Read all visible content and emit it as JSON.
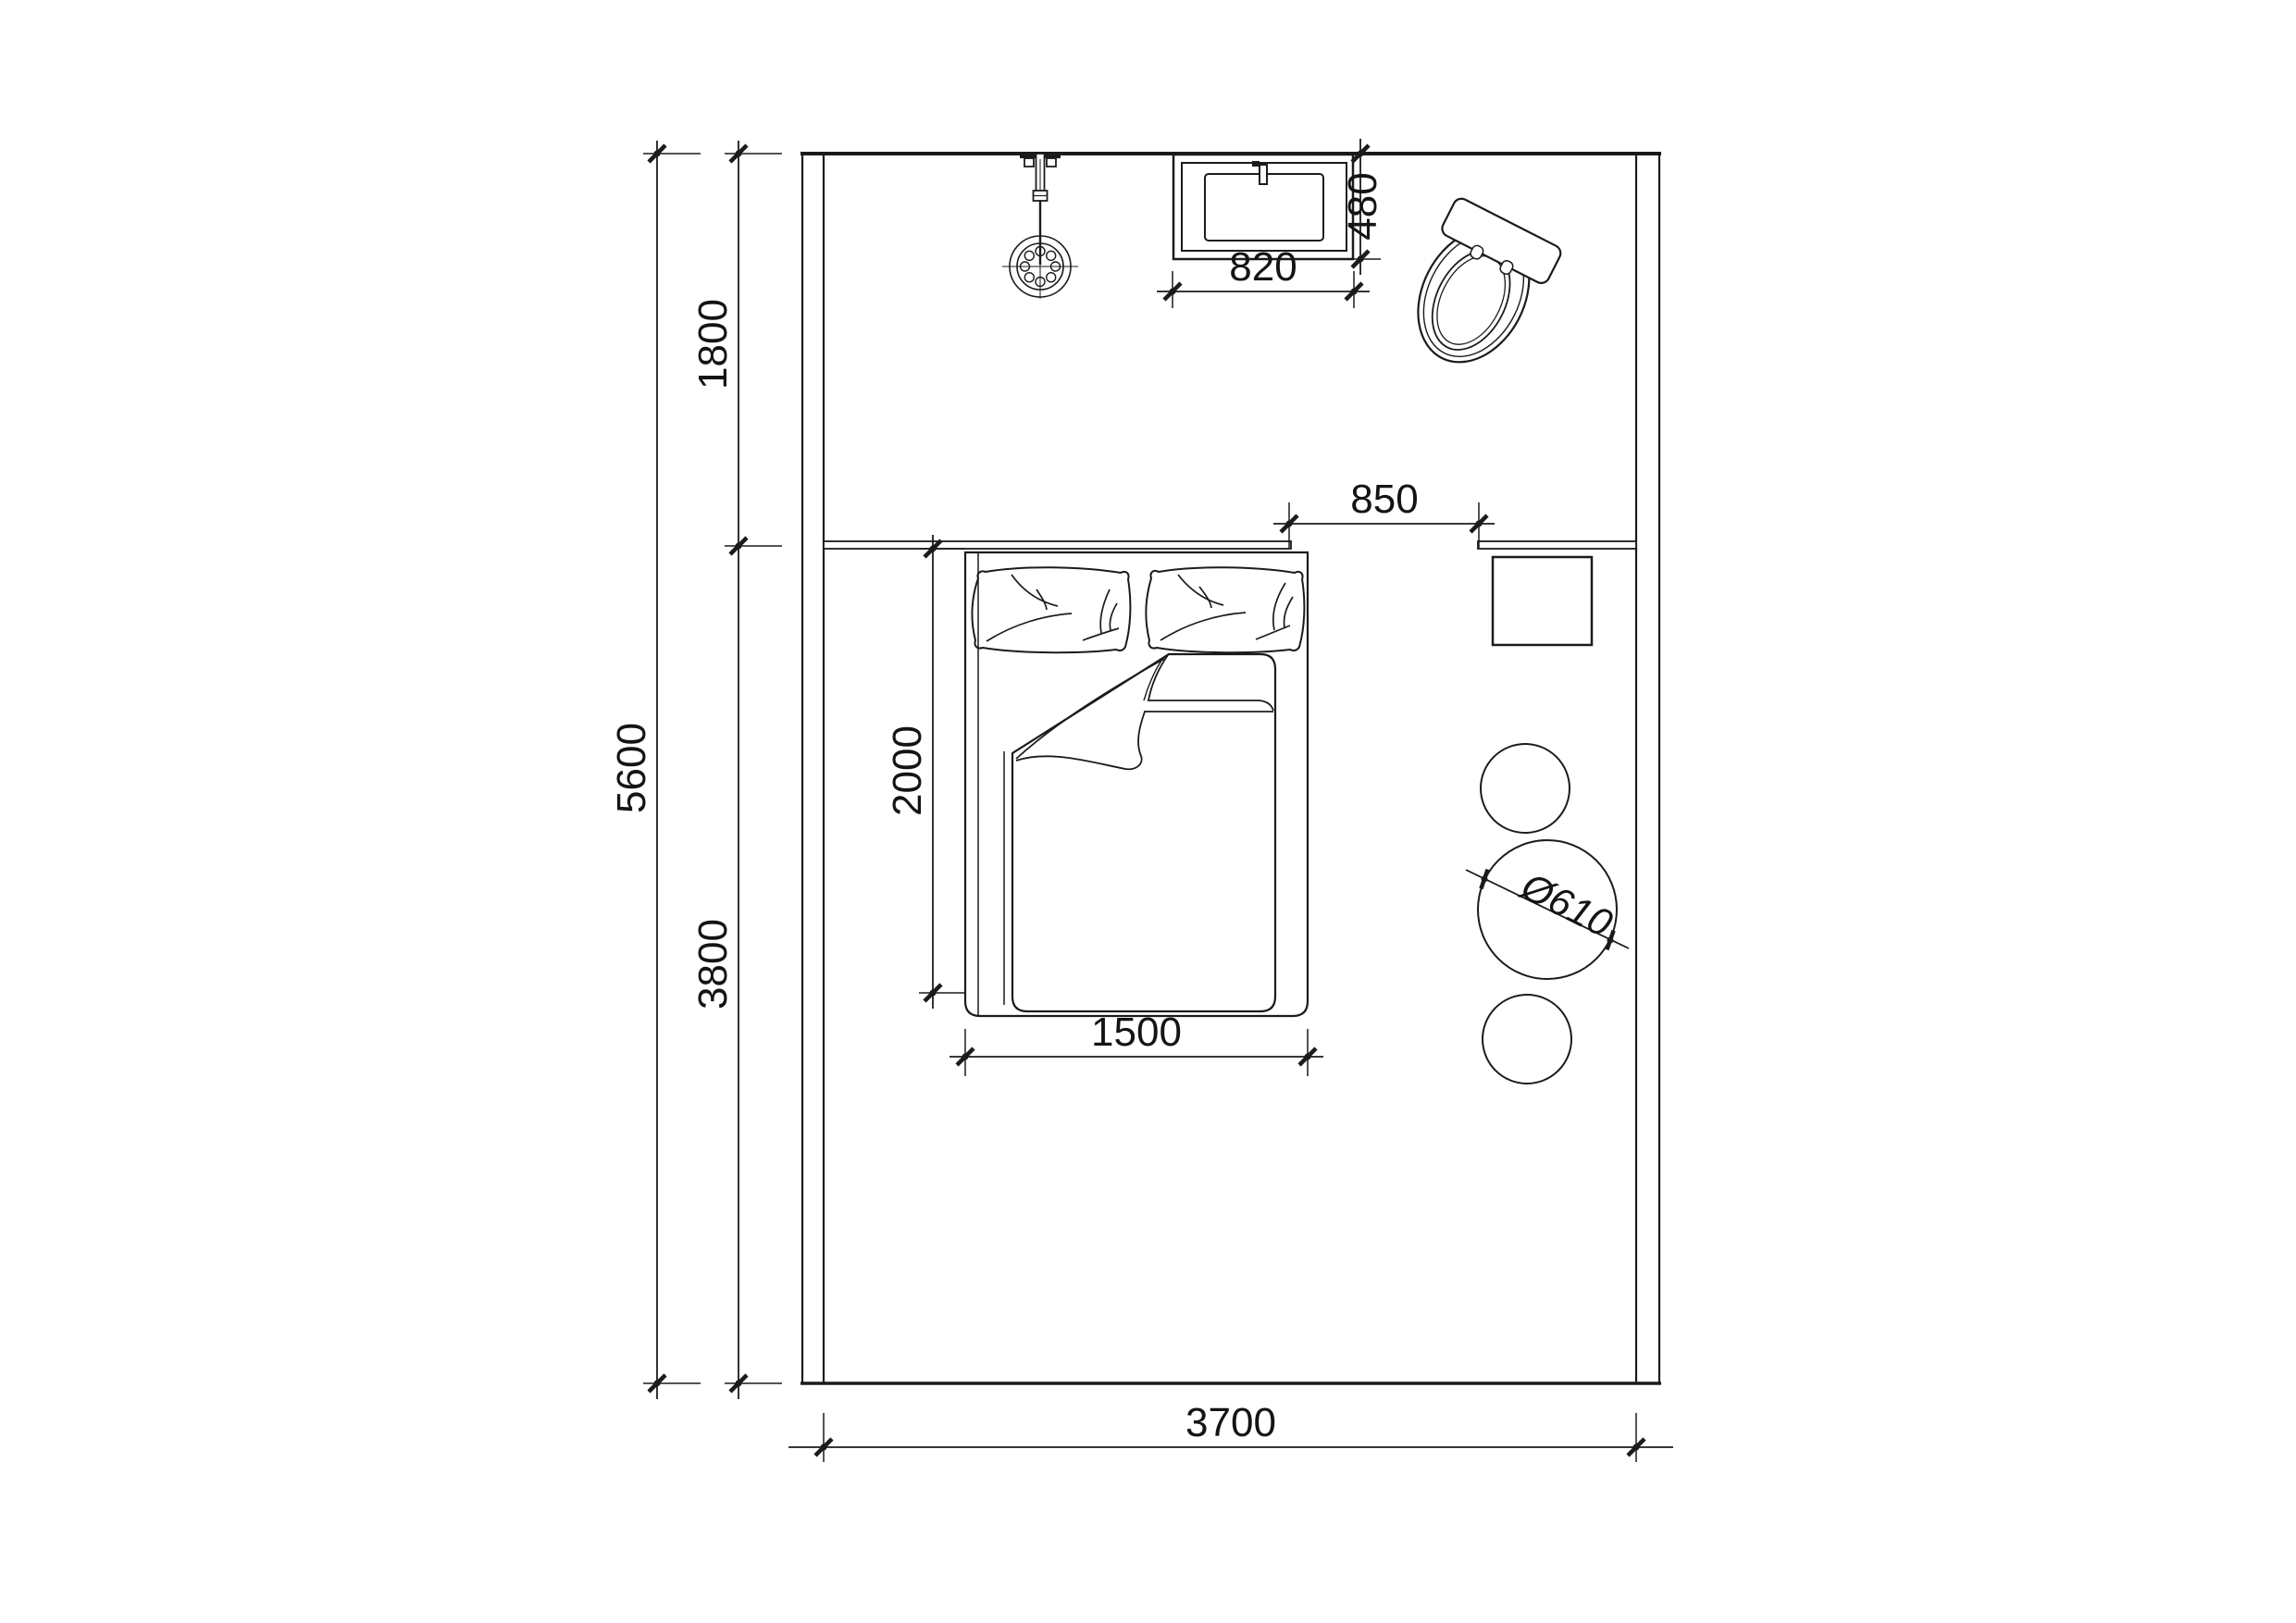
{
  "drawing": {
    "kind": "floor-plan",
    "background_color": "#ffffff",
    "line_color": "#1b1b1b"
  },
  "dimensions": {
    "room_length_total": "5600",
    "shower_zone_length": "1800",
    "bedroom_zone_length": "3800",
    "room_width": "3700",
    "washbasin_width": "820",
    "washbasin_depth": "480",
    "bed_to_shelf_gap": "850",
    "bed_length": "2000",
    "bed_width": "1500",
    "round_table_diameter": "Ø610"
  },
  "fixtures": {
    "shower": "wall-mounted shower with hand spray",
    "washbasin": "rectangular washbasin",
    "toilet": "toilet (rotated)",
    "bed": "double bed with two pillows and folded duvet",
    "headboard_ledge": "headboard ledge",
    "wall_shelf": "wall shelf / desk",
    "square_stool": "square stool",
    "round_stools": "two round stools",
    "round_table": "round table"
  }
}
